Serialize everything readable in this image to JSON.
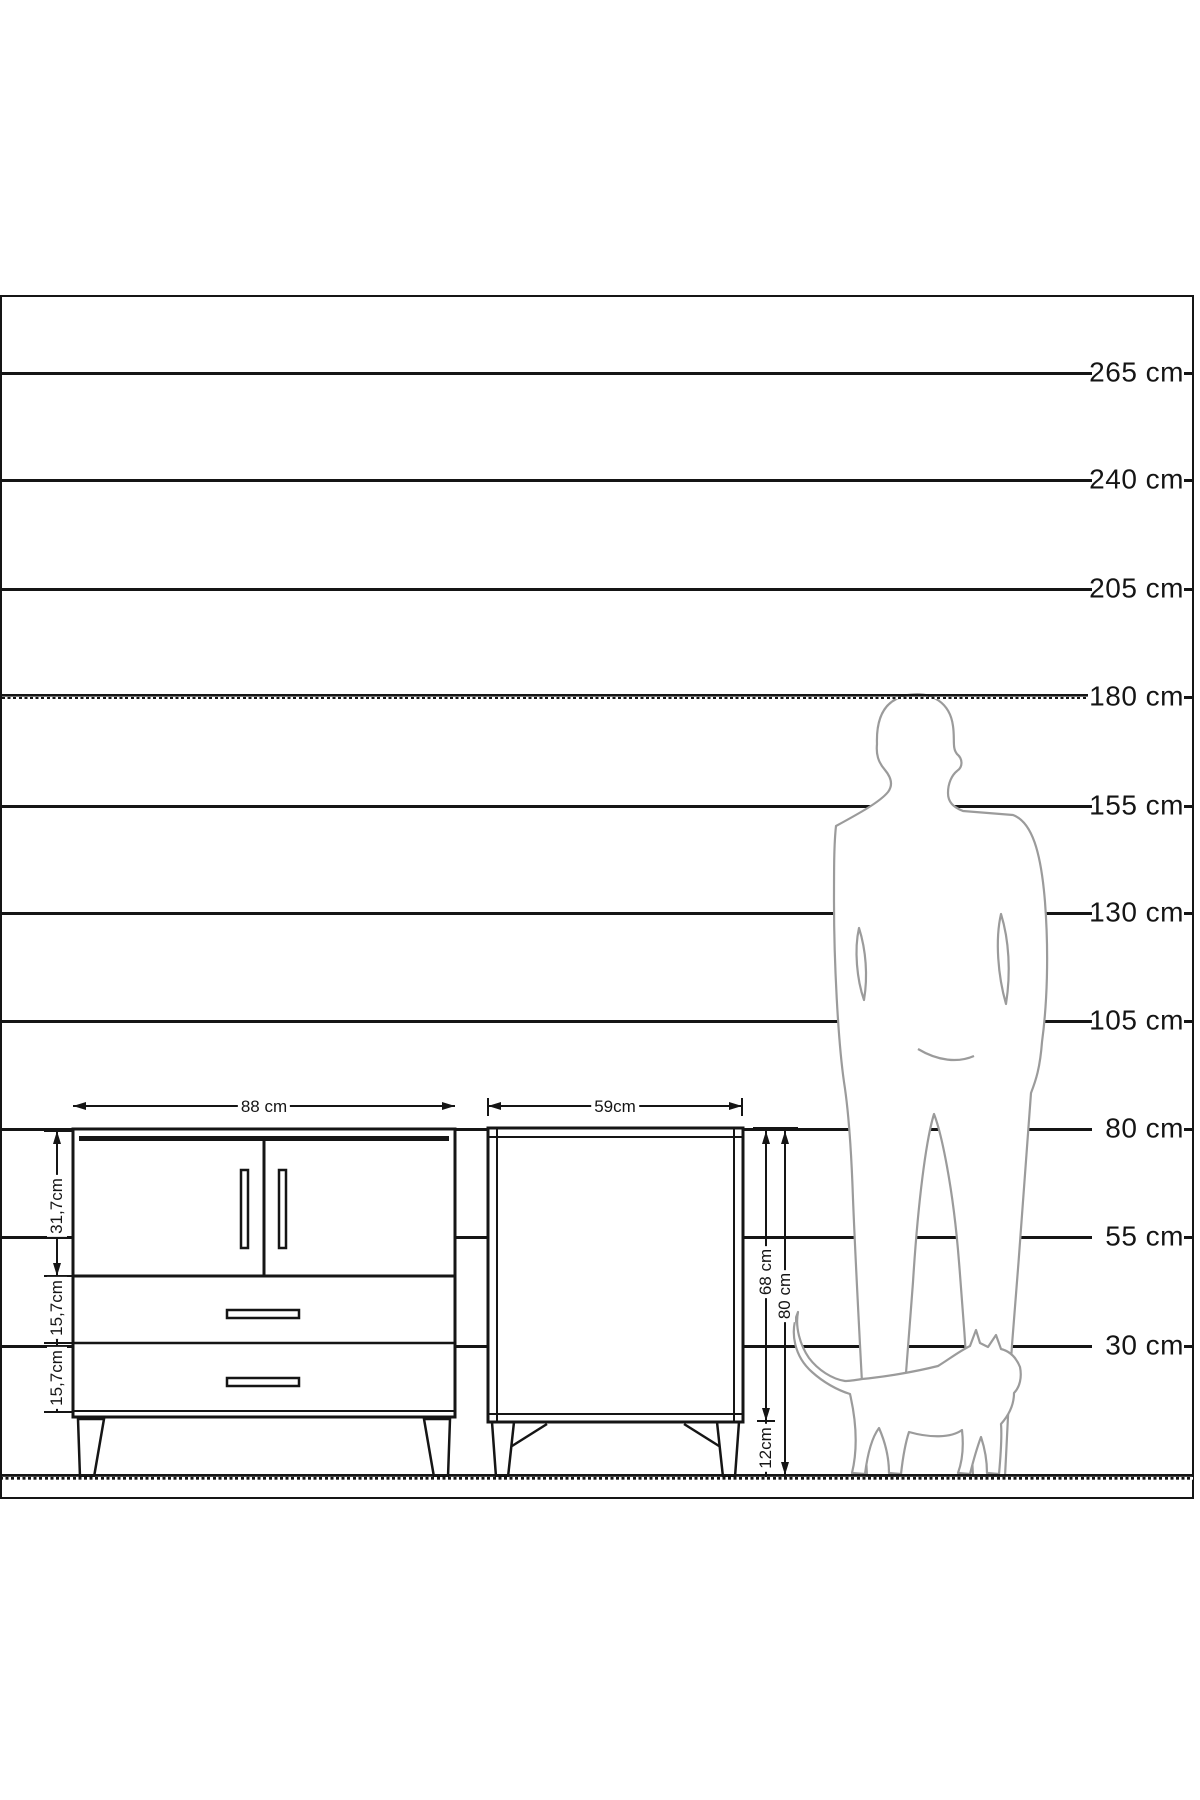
{
  "diagram": {
    "title": "furniture-size-comparison-diagram",
    "unit": "cm",
    "colors": {
      "line": "#151515",
      "silhouette": "#9b9b9b",
      "background": "#ffffff"
    },
    "height_scale": {
      "items": [
        {
          "label": "265 cm",
          "value": 265,
          "y": 373,
          "dashed": false
        },
        {
          "label": "240 cm",
          "value": 240,
          "y": 480,
          "dashed": false
        },
        {
          "label": "205 cm",
          "value": 205,
          "y": 589,
          "dashed": false
        },
        {
          "label": "180 cm",
          "value": 180,
          "y": 697,
          "dashed": true
        },
        {
          "label": "155 cm",
          "value": 155,
          "y": 806,
          "dashed": false
        },
        {
          "label": "130 cm",
          "value": 130,
          "y": 913,
          "dashed": false
        },
        {
          "label": "105 cm",
          "value": 105,
          "y": 1021,
          "dashed": false
        },
        {
          "label": "80 cm",
          "value": 80,
          "y": 1129,
          "dashed": false
        },
        {
          "label": "55 cm",
          "value": 55,
          "y": 1237,
          "dashed": false
        },
        {
          "label": "30 cm",
          "value": 30,
          "y": 1346,
          "dashed": false
        }
      ]
    },
    "front_view_cabinet": {
      "width_label": "88 cm",
      "door_section_height_label": "31,7cm",
      "drawer1_height_label": "15,7cm",
      "drawer2_height_label": "15,7cm"
    },
    "side_view_cabinet": {
      "width_label": "59cm",
      "body_height_label": "68 cm",
      "total_height_label": "80 cm",
      "leg_height_label": "12cm"
    },
    "figures": [
      "man-silhouette",
      "cat-silhouette"
    ]
  }
}
